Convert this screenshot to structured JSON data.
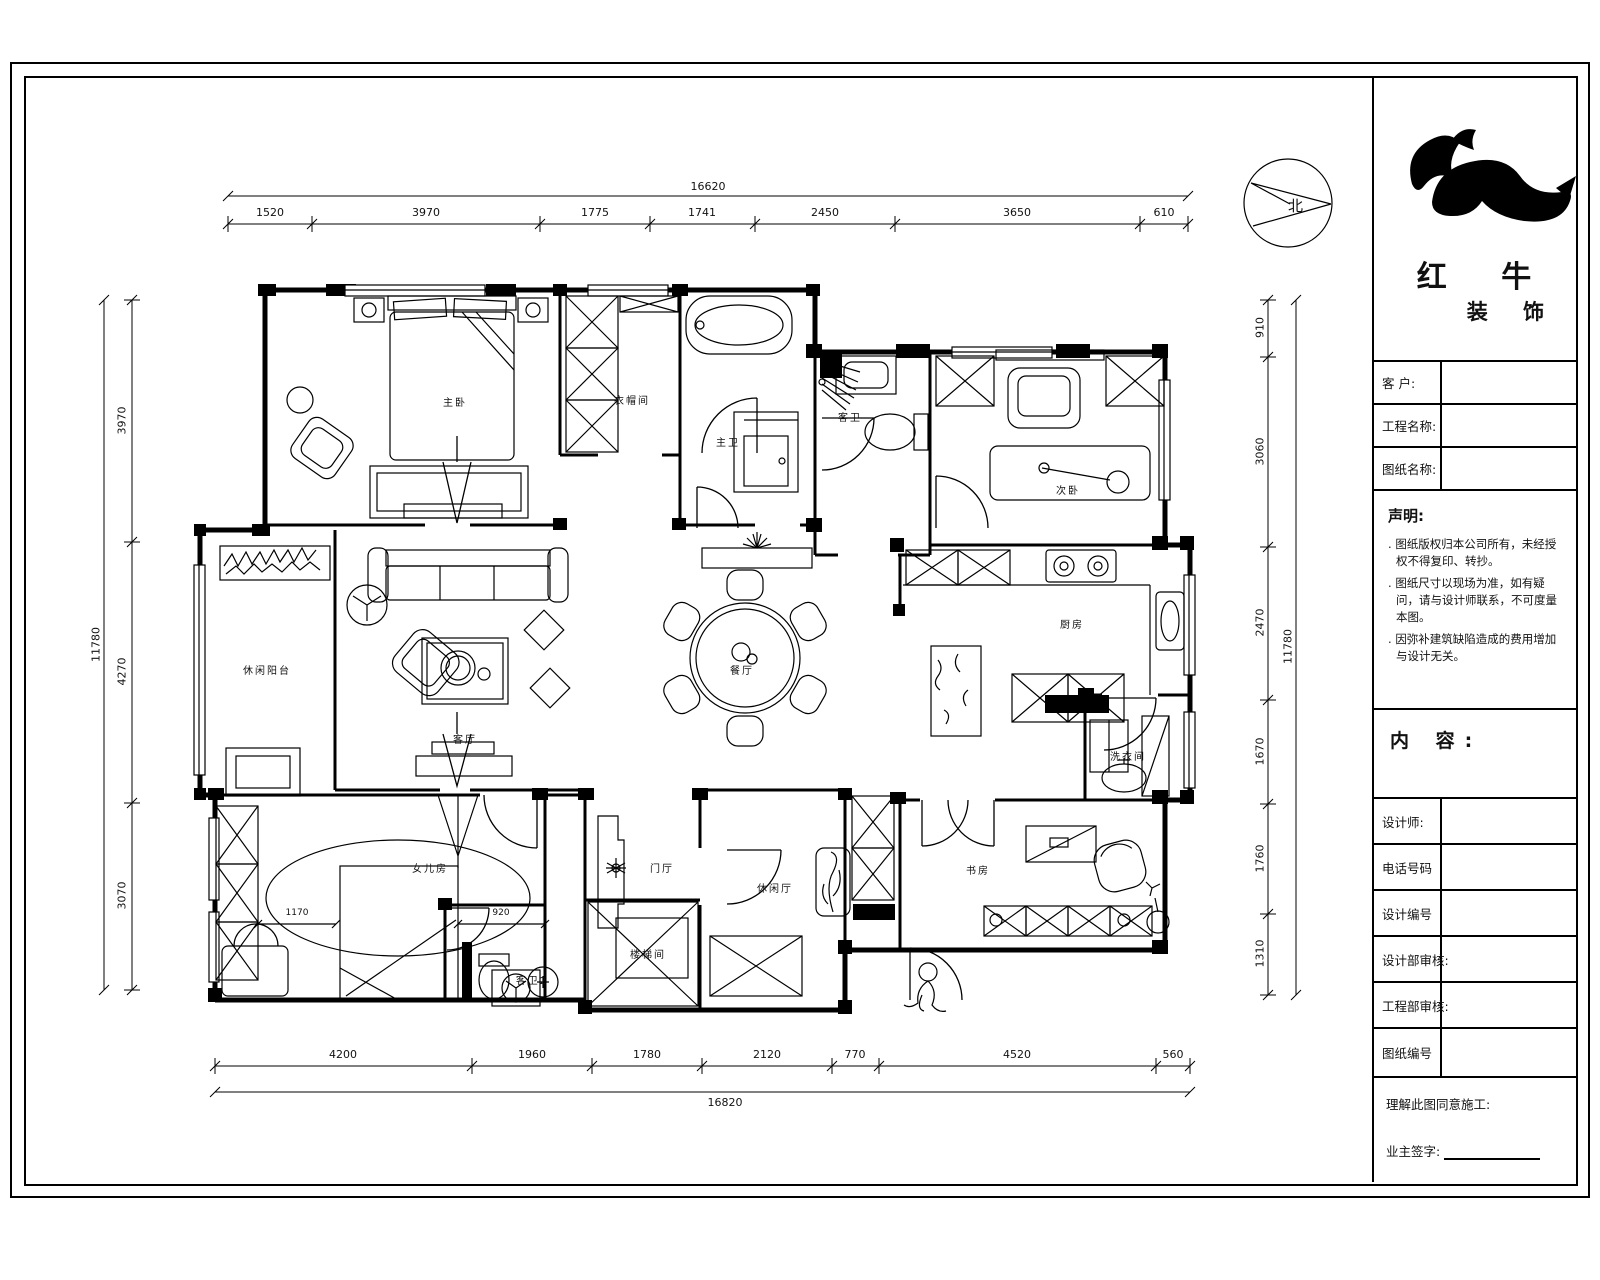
{
  "compass": {
    "label": "北"
  },
  "title_block": {
    "brand_line1": "红 牛",
    "brand_line2": "装 饰",
    "fields": {
      "customer": "客  户:",
      "project": "工程名称:",
      "drawing": "图纸名称:"
    },
    "statement": {
      "heading": "声明:",
      "items": [
        "图纸版权归本公司所有，未经授权不得复印、转抄。",
        "图纸尺寸以现场为准，如有疑问，请与设计师联系，不可度量本图。",
        "因弥补建筑缺陷造成的费用增加与设计无关。"
      ]
    },
    "content_label": "内 容:",
    "rows": [
      "设计师:",
      "电话号码",
      "设计编号",
      "设计部审核:",
      "工程部审核:",
      "图纸编号"
    ],
    "footer": {
      "line1": "理解此图同意施工:",
      "line2": "业主签字:"
    }
  },
  "rooms": {
    "master_bedroom": "主卧",
    "cloakroom": "衣帽间",
    "master_bath": "主卫",
    "guest_bath": "客卫",
    "second_bedroom": "次卧",
    "leisure_balcony": "休闲阳台",
    "living_room": "客厅",
    "dining_room": "餐厅",
    "kitchen": "厨房",
    "laundry": "洗衣间",
    "daughter_room": "女儿房",
    "guest_bath2": "客卫2",
    "entry_hall": "门厅",
    "stairwell": "楼梯间",
    "leisure_hall": "休闲厅",
    "study": "书房"
  },
  "inner_dims": {
    "bed_left": "1170",
    "bed_right": "920"
  },
  "dimensions": {
    "top": {
      "total": "16620",
      "segments": [
        "1520",
        "3970",
        "1775",
        "1741",
        "2450",
        "3650",
        "610"
      ]
    },
    "bottom": {
      "total": "16820",
      "segments": [
        "4200",
        "1960",
        "1780",
        "2120",
        "770",
        "4520",
        "560"
      ]
    },
    "left": {
      "total": "11780",
      "segments": [
        "3970",
        "4270",
        "3070"
      ]
    },
    "right": {
      "total": "11780",
      "segments": [
        "910",
        "3060",
        "2470",
        "1670",
        "1760",
        "1310"
      ]
    }
  }
}
